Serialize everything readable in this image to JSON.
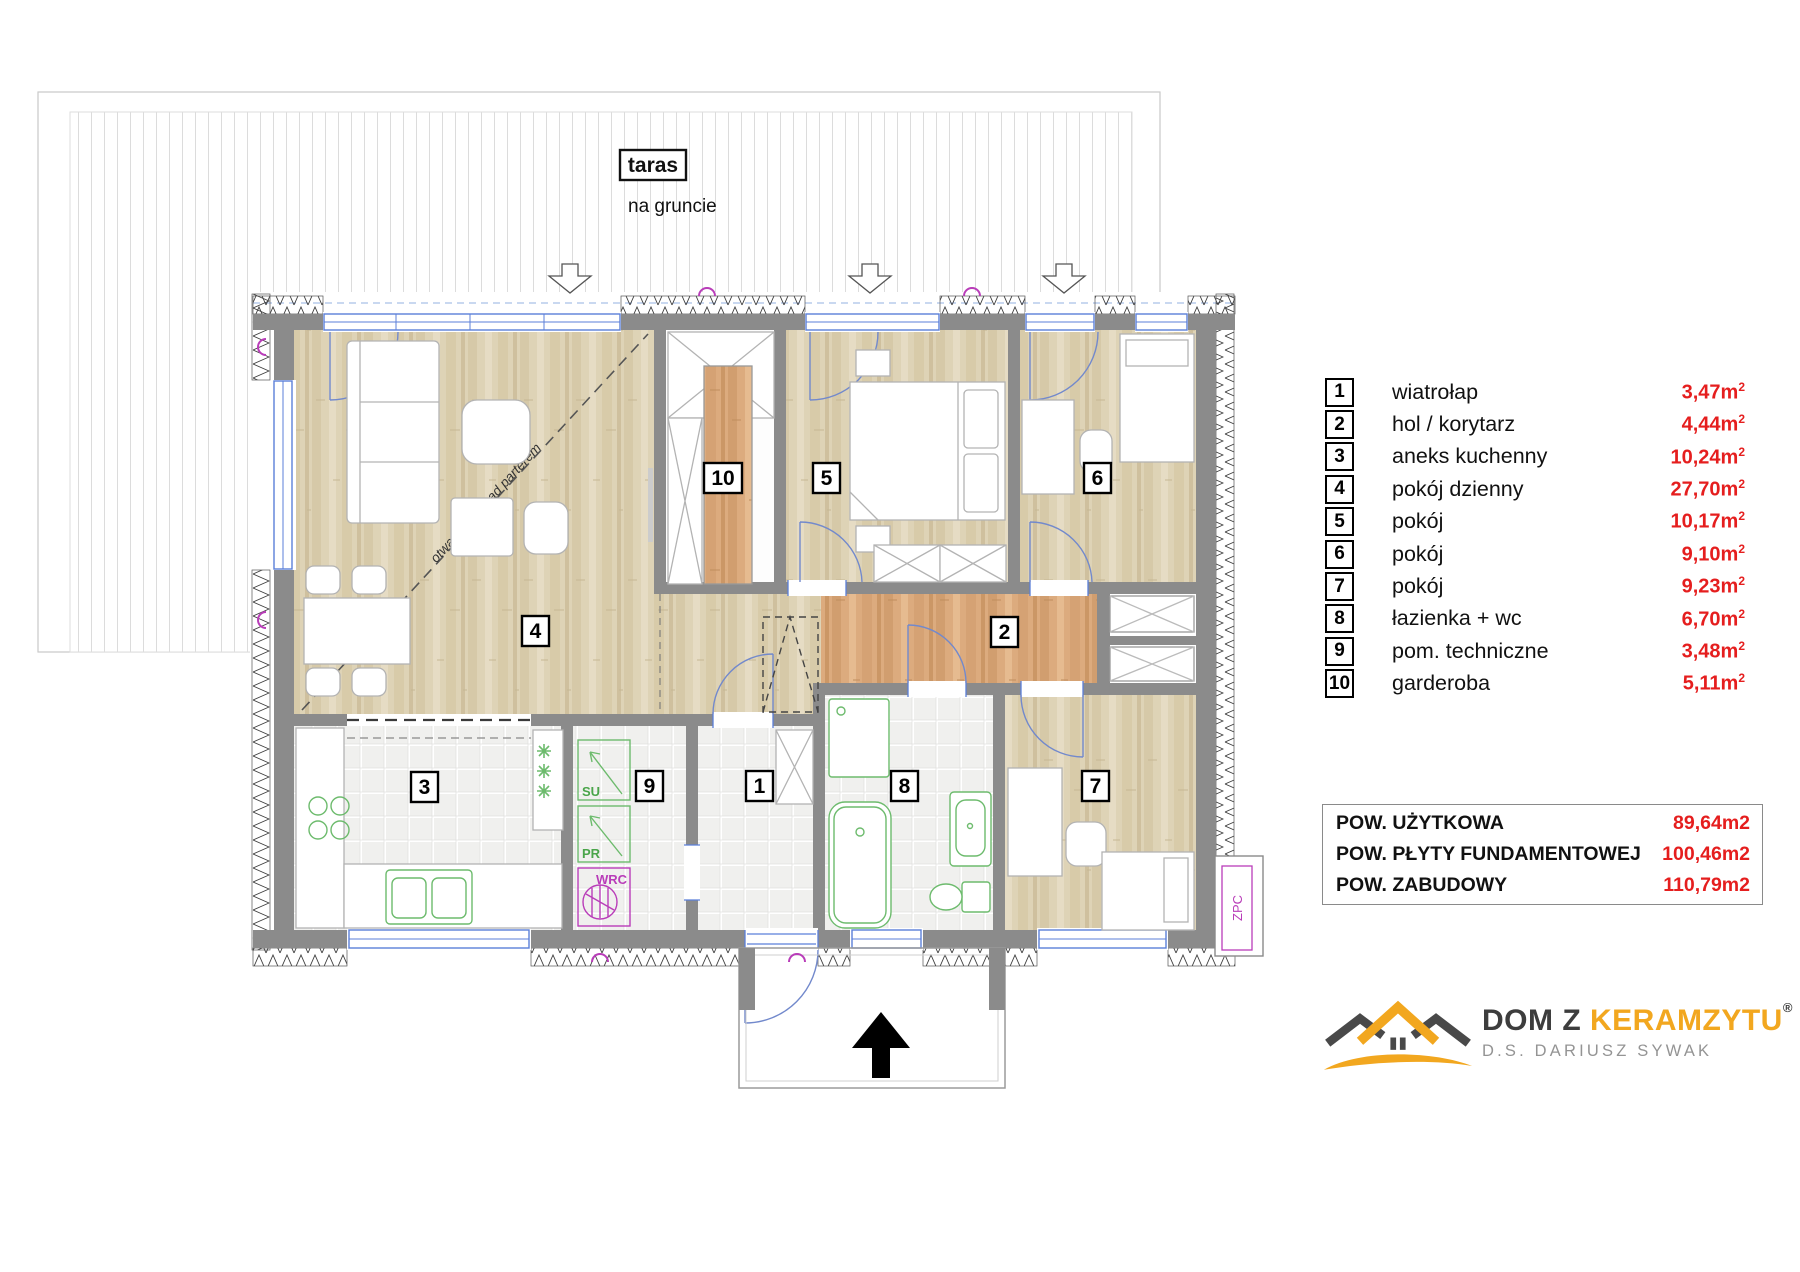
{
  "plan": {
    "terrace": {
      "label": "taras",
      "sublabel": "na gruncie"
    },
    "open_ceiling_note": "otwarty sufit nad parterem",
    "markers": [
      {
        "no": "1"
      },
      {
        "no": "2"
      },
      {
        "no": "3"
      },
      {
        "no": "4"
      },
      {
        "no": "5"
      },
      {
        "no": "6"
      },
      {
        "no": "7"
      },
      {
        "no": "8"
      },
      {
        "no": "9"
      },
      {
        "no": "10"
      }
    ],
    "tech": {
      "su": "SU",
      "pr": "PR",
      "wrc": "WRC",
      "zpc": "ZPC"
    }
  },
  "legend": {
    "rows": [
      {
        "no": "1",
        "name": "wiatrołap",
        "area": "3,47m",
        "sup": "2"
      },
      {
        "no": "2",
        "name": "hol / korytarz",
        "area": "4,44m",
        "sup": "2"
      },
      {
        "no": "3",
        "name": "aneks kuchenny",
        "area": "10,24m",
        "sup": "2"
      },
      {
        "no": "4",
        "name": "pokój dzienny",
        "area": "27,70m",
        "sup": "2"
      },
      {
        "no": "5",
        "name": "pokój",
        "area": "10,17m",
        "sup": "2"
      },
      {
        "no": "6",
        "name": "pokój",
        "area": "9,10m",
        "sup": "2"
      },
      {
        "no": "7",
        "name": "pokój",
        "area": "9,23m",
        "sup": "2"
      },
      {
        "no": "8",
        "name": "łazienka + wc",
        "area": "6,70m",
        "sup": "2"
      },
      {
        "no": "9",
        "name": "pom. techniczne",
        "area": "3,48m",
        "sup": "2"
      },
      {
        "no": "10",
        "name": "garderoba",
        "area": "5,11m",
        "sup": "2"
      }
    ]
  },
  "summary": {
    "rows": [
      {
        "label": "POW. UŻYTKOWA",
        "value": "89,64m2"
      },
      {
        "label": "POW. PŁYTY FUNDAMENTOWEJ",
        "value": "100,46m2"
      },
      {
        "label": "POW. ZABUDOWY",
        "value": "110,79m2"
      }
    ]
  },
  "logo": {
    "brand_prefix": "DOM Z",
    "brand_accent": "KERAMZYTU",
    "registered": "®",
    "subtitle": "D.S. DARIUSZ SYWAK"
  },
  "colors": {
    "accent_red": "#e51e1e",
    "logo_yellow": "#f2a71f",
    "wall_gray": "#8b8b8b",
    "window_blue": "#5b7fd9",
    "fixture_green": "#6dbb6d",
    "symbol_purple": "#b93db9",
    "wood_light": "#ded3b6",
    "wood_orange": "#dcab7e"
  }
}
